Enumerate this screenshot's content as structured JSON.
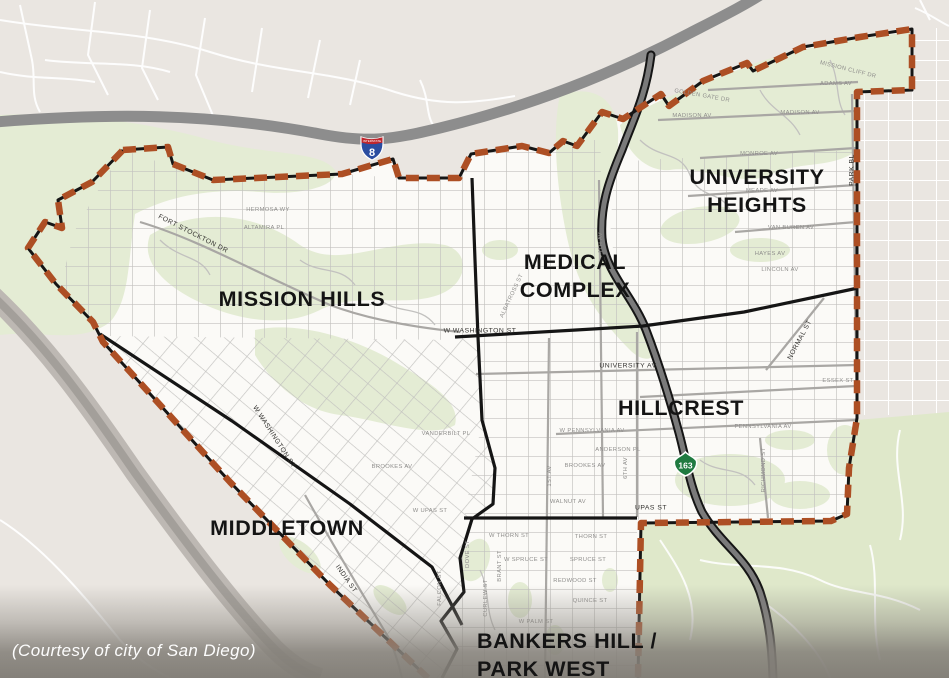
{
  "map": {
    "caption": "(Courtesy of city of San Diego)",
    "neighborhoods": [
      {
        "name": "MISSION HILLS",
        "lines": [
          "MISSION HILLS"
        ]
      },
      {
        "name": "MIDDLETOWN",
        "lines": [
          "MIDDLETOWN"
        ]
      },
      {
        "name": "MEDICAL COMPLEX",
        "lines": [
          "MEDICAL",
          "COMPLEX"
        ]
      },
      {
        "name": "UNIVERSITY HEIGHTS",
        "lines": [
          "UNIVERSITY",
          "HEIGHTS"
        ]
      },
      {
        "name": "HILLCREST",
        "lines": [
          "HILLCREST"
        ]
      },
      {
        "name": "BANKERS HILL / PARK WEST",
        "lines": [
          "BANKERS HILL /",
          "PARK WEST"
        ]
      }
    ],
    "shields": [
      {
        "system": "interstate",
        "banner": "INTERSTATE",
        "route": "8"
      },
      {
        "system": "california-state-route",
        "route": "163"
      }
    ],
    "street_labels": [
      {
        "label": "FORT STOCKTON DR",
        "x": 193,
        "y": 234,
        "r": 27,
        "emph": true
      },
      {
        "label": "W WASHINGTON ST",
        "x": 274,
        "y": 437,
        "r": 57,
        "emph": true
      },
      {
        "label": "W WASHINGTON ST",
        "x": 480,
        "y": 331,
        "r": 0,
        "emph": true
      },
      {
        "label": "UNIVERSITY AV",
        "x": 628,
        "y": 366,
        "r": 0,
        "emph": true
      },
      {
        "label": "UPAS ST",
        "x": 651,
        "y": 508,
        "r": 0,
        "emph": true
      },
      {
        "label": "W UPAS ST",
        "x": 430,
        "y": 511,
        "r": 0
      },
      {
        "label": "INDIA ST",
        "x": 346,
        "y": 579,
        "r": 55,
        "emph": true
      },
      {
        "label": "PARK BL",
        "x": 852,
        "y": 170,
        "r": -90,
        "emph": true
      },
      {
        "label": "NORMAL ST",
        "x": 800,
        "y": 340,
        "r": -62,
        "emph": true
      },
      {
        "label": "MADISON AV",
        "x": 692,
        "y": 116,
        "r": 0
      },
      {
        "label": "MADISON AV",
        "x": 800,
        "y": 113,
        "r": 0
      },
      {
        "label": "ADAMS AV",
        "x": 836,
        "y": 84,
        "r": 0
      },
      {
        "label": "GOLDEN GATE DR",
        "x": 702,
        "y": 96,
        "r": 10
      },
      {
        "label": "MISSION CLIFF DR",
        "x": 848,
        "y": 70,
        "r": 14
      },
      {
        "label": "MONROE AV",
        "x": 759,
        "y": 154,
        "r": 0
      },
      {
        "label": "MEADE AV",
        "x": 762,
        "y": 191,
        "r": 0
      },
      {
        "label": "VAN BUREN AV",
        "x": 791,
        "y": 228,
        "r": 0
      },
      {
        "label": "HAYES AV",
        "x": 770,
        "y": 254,
        "r": 0
      },
      {
        "label": "LINCOLN AV",
        "x": 780,
        "y": 270,
        "r": 0
      },
      {
        "label": "ESSEX ST",
        "x": 838,
        "y": 381,
        "r": 0
      },
      {
        "label": "PENNSYLVANIA AV",
        "x": 763,
        "y": 427,
        "r": 0
      },
      {
        "label": "W PENNSYLVANIA AV",
        "x": 592,
        "y": 431,
        "r": 0
      },
      {
        "label": "ANDERSON PL",
        "x": 618,
        "y": 450,
        "r": 0
      },
      {
        "label": "BROOKES AV",
        "x": 585,
        "y": 466,
        "r": 0
      },
      {
        "label": "BROOKES AV",
        "x": 392,
        "y": 467,
        "r": 0
      },
      {
        "label": "WALNUT AV",
        "x": 568,
        "y": 502,
        "r": 0
      },
      {
        "label": "VANDERBILT PL",
        "x": 446,
        "y": 434,
        "r": 0
      },
      {
        "label": "ALBATROSS ST",
        "x": 512,
        "y": 296,
        "r": -65
      },
      {
        "label": "RICHMOND ST",
        "x": 764,
        "y": 470,
        "r": -90
      },
      {
        "label": "1ST AV",
        "x": 550,
        "y": 476,
        "r": -90
      },
      {
        "label": "4TH AV",
        "x": 601,
        "y": 243,
        "r": -90
      },
      {
        "label": "6TH AV",
        "x": 626,
        "y": 468,
        "r": -90
      },
      {
        "label": "CURLEW ST",
        "x": 486,
        "y": 598,
        "r": -90
      },
      {
        "label": "BRANT ST",
        "x": 500,
        "y": 566,
        "r": -90
      },
      {
        "label": "DOVE ST",
        "x": 468,
        "y": 554,
        "r": -90
      },
      {
        "label": "FALCON ST",
        "x": 440,
        "y": 588,
        "r": -90
      },
      {
        "label": "W THORN ST",
        "x": 509,
        "y": 536,
        "r": 0
      },
      {
        "label": "THORN ST",
        "x": 591,
        "y": 537,
        "r": 0
      },
      {
        "label": "W SPRUCE ST",
        "x": 526,
        "y": 560,
        "r": 0
      },
      {
        "label": "SPRUCE ST",
        "x": 588,
        "y": 560,
        "r": 0
      },
      {
        "label": "REDWOOD ST",
        "x": 575,
        "y": 581,
        "r": 0
      },
      {
        "label": "QUINCE ST",
        "x": 590,
        "y": 601,
        "r": 0
      },
      {
        "label": "W PALM ST",
        "x": 536,
        "y": 622,
        "r": 0
      },
      {
        "label": "HERMOSA WY",
        "x": 268,
        "y": 210,
        "r": 0
      },
      {
        "label": "ALTAMIRA PL",
        "x": 264,
        "y": 228,
        "r": 0
      }
    ],
    "colors": {
      "outside_bg": "#eae6e1",
      "inside_bg": "#fbfaf7",
      "park_green": "#e4ecd4",
      "balboa_green": "#dfe8ca",
      "community_boundary_dash": "#ad4f24",
      "neighborhood_divider": "#151515",
      "freeway_gray": "#8d8d8d",
      "street_gray": "#c2c1bf",
      "interstate_shield_blue": "#2b4da0",
      "interstate_shield_red": "#c0272d",
      "state_route_green": "#1f7a40",
      "caption_band_gray": "#8a8780"
    }
  }
}
